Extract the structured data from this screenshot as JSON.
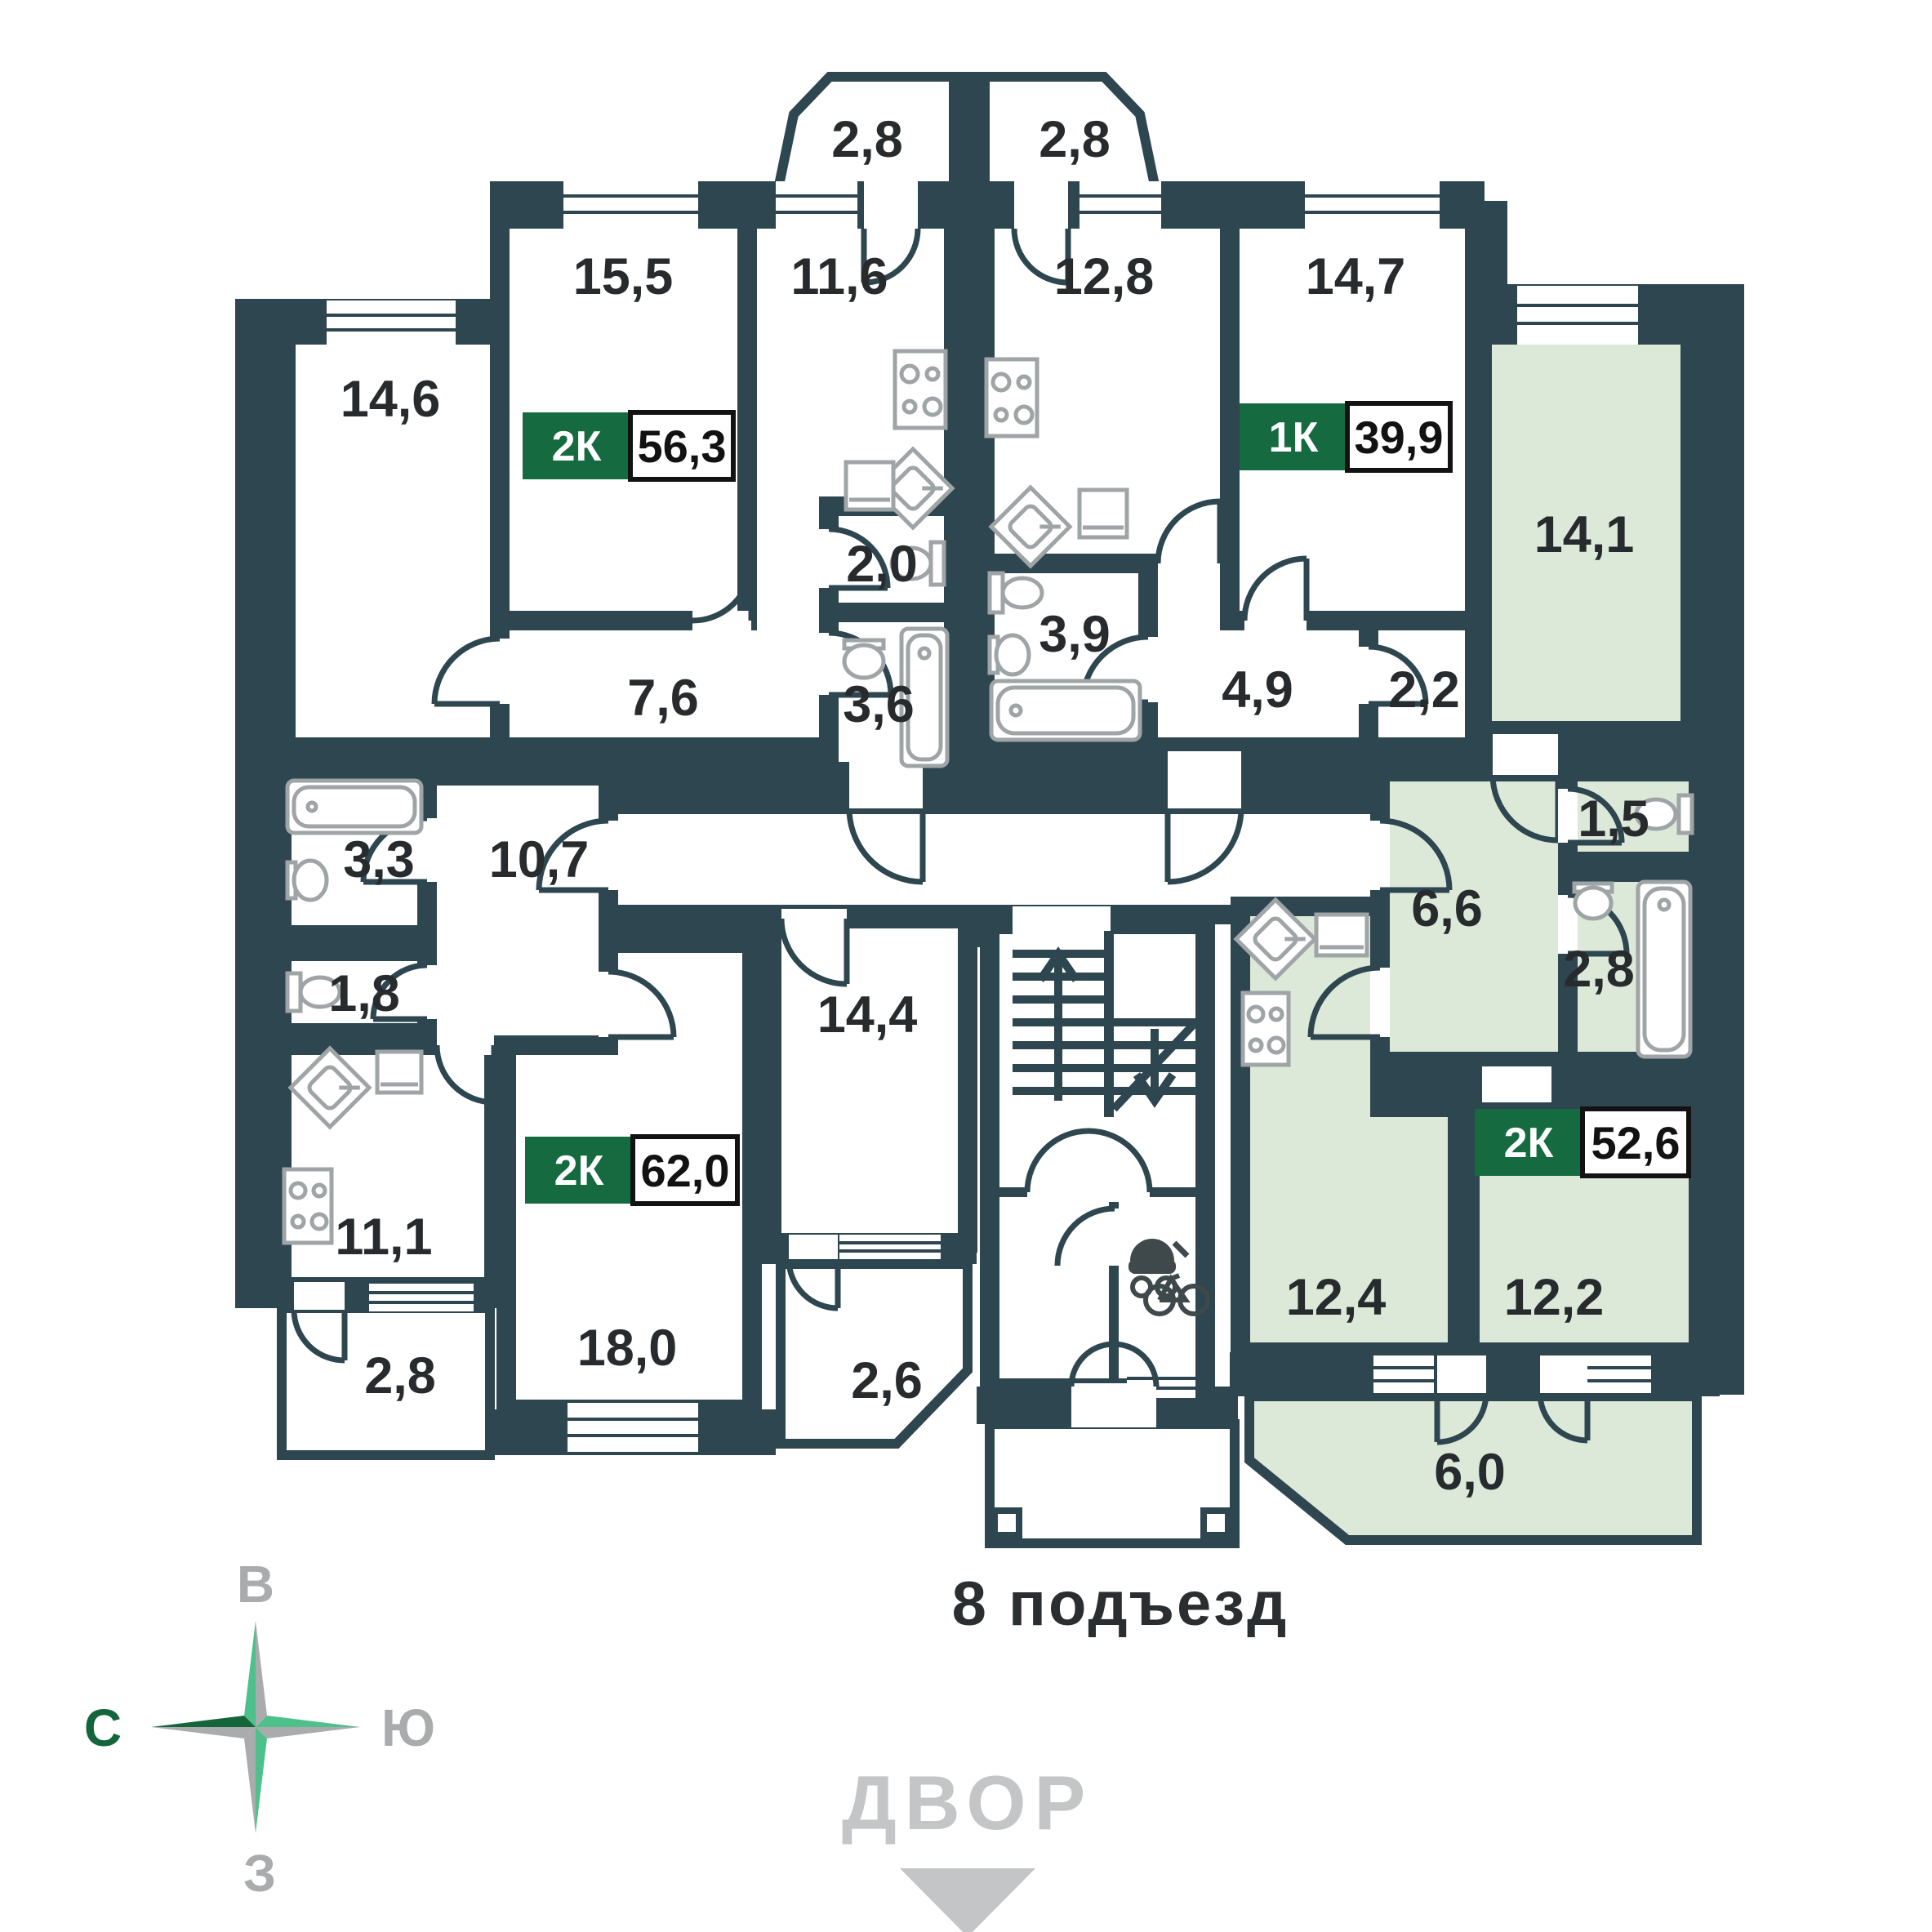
{
  "colors": {
    "wall": "#2E464F",
    "room": "#FFFFFF",
    "highlighted_room": "#DCE9D8",
    "badge_green": "#156B3F",
    "text_dark": "#272B2D",
    "fixture_gray": "#9FA4A6",
    "muted_gray": "#C3C5C7",
    "compass_green": "#4EC08B",
    "compass_dark_green": "#15653C",
    "compass_gray": "#A9ABAD"
  },
  "apartments": [
    {
      "id": "apt-top-left",
      "type_label": "2К",
      "area_total": "56,3",
      "highlighted": false,
      "rooms": {
        "balcony": "2,8",
        "living": "15,5",
        "kitchen": "11,6",
        "bedroom": "14,6",
        "wc": "2,0",
        "bath": "3,6",
        "hall": "7,6"
      }
    },
    {
      "id": "apt-top-right",
      "type_label": "1К",
      "area_total": "39,9",
      "highlighted": false,
      "rooms": {
        "balcony": "2,8",
        "kitchen": "12,8",
        "living": "14,7",
        "bath": "3,9",
        "hall": "4,9",
        "storage": "2,2"
      }
    },
    {
      "id": "apt-bottom-left",
      "type_label": "2К",
      "area_total": "62,0",
      "highlighted": false,
      "rooms": {
        "bath": "3,3",
        "wc": "1,8",
        "hall": "10,7",
        "kitchen": "11,1",
        "living": "18,0",
        "bedroom": "14,4",
        "balcony_a": "2,8",
        "balcony_b": "2,6"
      }
    },
    {
      "id": "apt-bottom-right",
      "type_label": "2К",
      "area_total": "52,6",
      "highlighted": true,
      "rooms": {
        "bedroom": "14,1",
        "hall": "6,6",
        "wc": "1,5",
        "bath": "2,8",
        "kitchen": "12,4",
        "living": "12,2",
        "balcony": "6,0"
      }
    }
  ],
  "entrance": {
    "label": "8 подъезд"
  },
  "courtyard": {
    "label": "ДВОР"
  },
  "compass": {
    "east": "В",
    "south": "Ю",
    "west": "З",
    "north": "С"
  }
}
